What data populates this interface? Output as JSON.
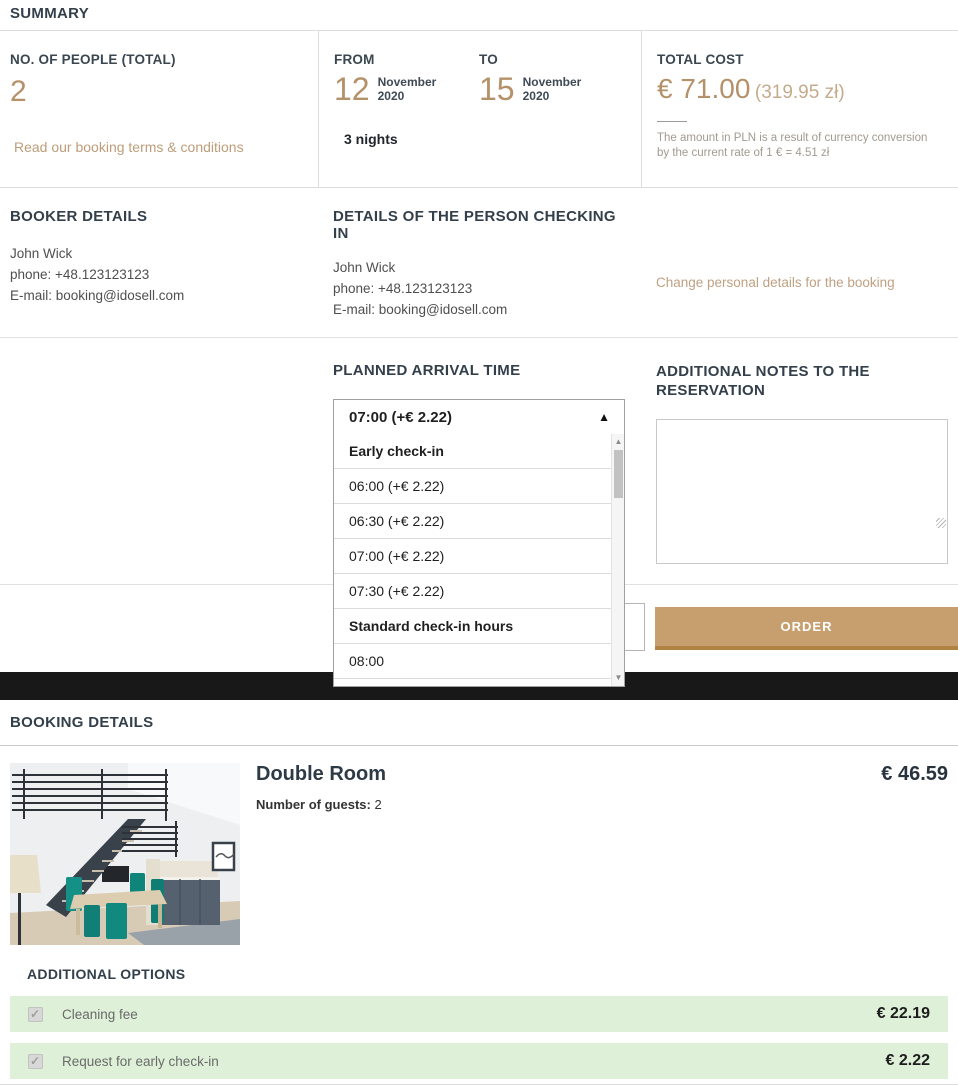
{
  "colors": {
    "accent_tan": "#b5916a",
    "accent_tan_light": "#c4ab8c",
    "link_tan": "#bfa183",
    "heading_dark": "#333f4a",
    "button_bg": "#c79e6d",
    "button_border": "#b08343",
    "option_row_bg": "#dff0d8",
    "black_bar": "#181818"
  },
  "summary": {
    "title": "SUMMARY",
    "people_label": "NO. OF PEOPLE (TOTAL)",
    "people_value": "2",
    "terms_link": "Read our booking terms & conditions",
    "from_label": "FROM",
    "from_day": "12",
    "from_month": "November",
    "from_year": "2020",
    "to_label": "TO",
    "to_day": "15",
    "to_month": "November",
    "to_year": "2020",
    "nights": "3 nights",
    "total_label": "TOTAL COST",
    "total_eur": "€ 71.00",
    "total_pln": "(319.95 zł)",
    "conversion_note_line1": "The amount in PLN is a result of currency conversion",
    "conversion_note_line2": "by the current rate of 1 € = 4.51 zł"
  },
  "booker": {
    "title": "BOOKER DETAILS",
    "name": "John Wick",
    "phone": "phone: +48.123123123",
    "email": "E-mail: booking@idosell.com"
  },
  "checkin_person": {
    "title": "DETAILS OF THE PERSON CHECKING IN",
    "name": "John Wick",
    "phone": "phone: +48.123123123",
    "email": "E-mail: booking@idosell.com",
    "change_link": "Change personal details for the booking"
  },
  "arrival": {
    "title": "PLANNED ARRIVAL TIME",
    "selected_value": "07:00 (+€ 2.22)",
    "dropdown_caret": "▲",
    "options": [
      {
        "label": "Early check-in",
        "group": true
      },
      {
        "label": "06:00 (+€ 2.22)",
        "group": false
      },
      {
        "label": "06:30 (+€ 2.22)",
        "group": false
      },
      {
        "label": "07:00 (+€ 2.22)",
        "group": false
      },
      {
        "label": "07:30 (+€ 2.22)",
        "group": false
      },
      {
        "label": "Standard check-in hours",
        "group": true
      },
      {
        "label": "08:00",
        "group": false
      }
    ],
    "scroll_up_glyph": "▲",
    "scroll_down_glyph": "▼"
  },
  "notes": {
    "title": "ADDITIONAL NOTES TO THE RESERVATION",
    "value": ""
  },
  "order_row": {
    "input_value": "",
    "button_label": "ORDER"
  },
  "booking_details": {
    "title": "BOOKING DETAILS",
    "room_name": "Double Room",
    "guests_label": "Number of guests:",
    "guests_value": "2",
    "price": "€ 46.59"
  },
  "additional_options": {
    "title": "ADDITIONAL OPTIONS",
    "items": [
      {
        "label": "Cleaning fee",
        "price": "€ 22.19",
        "checked": true
      },
      {
        "label": "Request for early check-in",
        "price": "€ 2.22",
        "checked": true
      }
    ]
  }
}
